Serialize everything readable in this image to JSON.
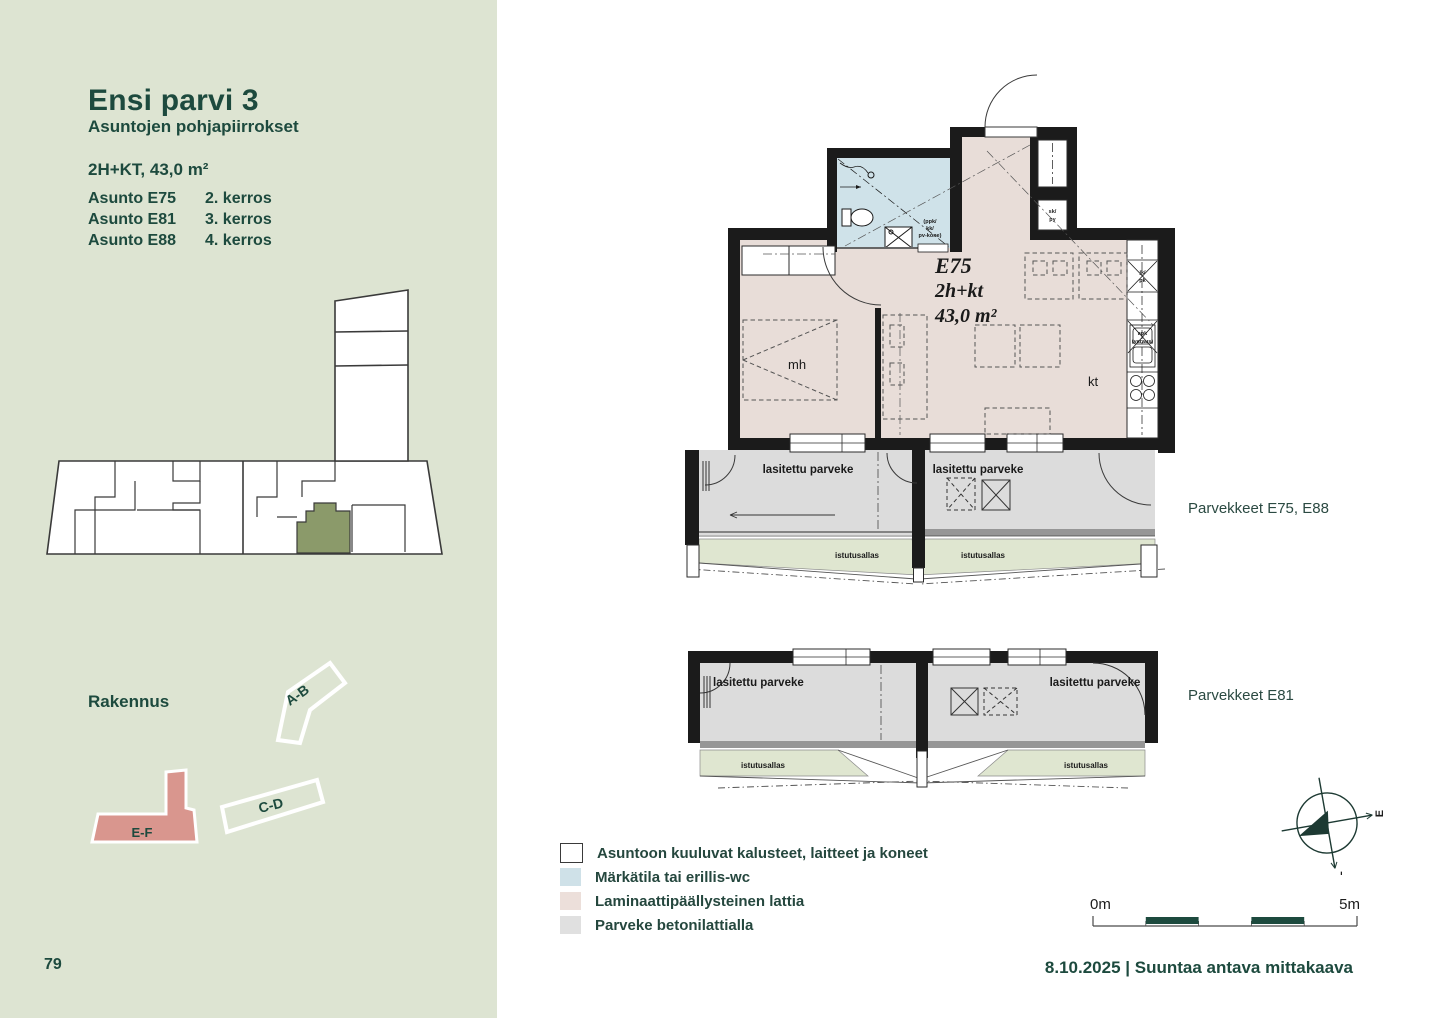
{
  "page": {
    "number": "79",
    "footer": "8.10.2025 | Suuntaa antava mittakaava"
  },
  "sidebar": {
    "title": "Ensi parvi 3",
    "subtitle": "Asuntojen pohjapiirrokset",
    "unit_summary": "2H+KT, 43,0 m²",
    "apartments": [
      {
        "name": "Asunto E75",
        "floor": "2. kerros"
      },
      {
        "name": "Asunto E81",
        "floor": "3. kerros"
      },
      {
        "name": "Asunto E88",
        "floor": "4. kerros"
      }
    ],
    "building_label": "Rakennus",
    "buildings": {
      "ab": "A-B",
      "cd": "C-D",
      "ef": "E-F"
    }
  },
  "plan": {
    "unit_id": "E75",
    "unit_type": "2h+kt",
    "unit_area": "43,0 m²",
    "rooms": {
      "bedroom": "mh",
      "kitchen": "kt"
    },
    "closet": {
      "line1": "sk/",
      "line2": "py"
    },
    "appliances": {
      "fridge_line1": "jk/",
      "fridge_line2": "pk",
      "dishwasher_line1": "apk",
      "dishwasher_line2": "(varaus)"
    },
    "laundry": {
      "line1": "(ppk/",
      "line2": "kk/",
      "line3": "pv-kone)"
    }
  },
  "balconies": {
    "glazed_label": "lasitettu parveke",
    "planter_label": "istutusallas",
    "caption_top": "Parvekkeet E75, E88",
    "caption_bottom": "Parvekkeet E81"
  },
  "legend": {
    "items": [
      {
        "label": "Asuntoon kuuluvat kalusteet, laitteet ja koneet",
        "color": "#ffffff"
      },
      {
        "label": "Märkätila tai erillis-wc",
        "color": "#cfe1e8"
      },
      {
        "label": "Laminaattipäällysteinen lattia",
        "color": "#ecdfda"
      },
      {
        "label": "Parveke betonilattialla",
        "color": "#e0e0e0"
      }
    ]
  },
  "compass": {
    "top": "I",
    "right": "E",
    "bottom": "L",
    "left": "P"
  },
  "scalebar": {
    "start": "0m",
    "end": "5m"
  },
  "colors": {
    "accent": "#1d4a3e",
    "sidebar_bg": "#dde4d2",
    "wet_room": "#cfe2e9",
    "laminate": "#e8ddd8",
    "balcony_floor": "#dcdcdc",
    "planter": "#dfe6d0",
    "site_highlight": "#8b9a6a",
    "building_highlight": "#d9968e",
    "walls": "#1b1b1b"
  }
}
